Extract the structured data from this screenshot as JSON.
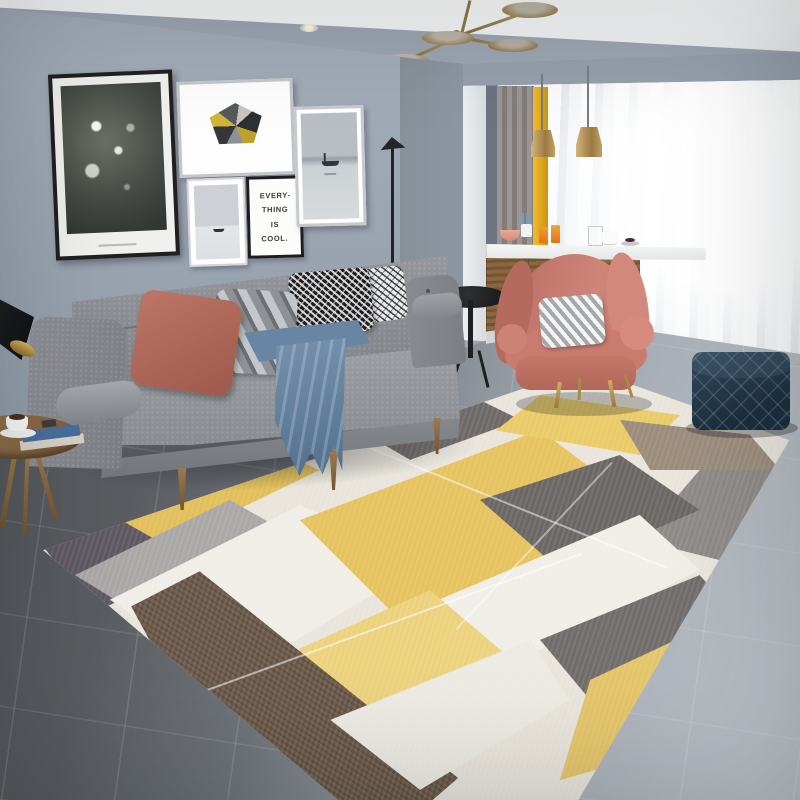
{
  "meta": {
    "title": "Scandinavian living room with yellow-gray geometric area rug",
    "image_type": "interior photograph, no UI text except framed quote art"
  },
  "wall_art": {
    "quote": {
      "lines": [
        "EVERY-",
        "THING",
        "IS",
        "COOL."
      ]
    },
    "frames": [
      "black-framed black & white botanical photo",
      "silver-framed geometric gem print (gold, black, marble triangles)",
      "small white-framed seascape with boat",
      "black-framed handwritten quote print",
      "silver-framed seascape with fisherman boat"
    ]
  },
  "palette": {
    "wall": "#9ca6b2",
    "wall_return": "#8d97a3",
    "ceiling": "#f6f7f8",
    "floor_dark": "#54575b",
    "floor_light": "#b9bec5",
    "sofa_gray": "#8d9094",
    "pillow_rose": "#b26a5c",
    "pillow_chevron_gray": "#8e9297",
    "blanket_blue": "#64819e",
    "armchair_pink": "#c87c70",
    "pouf_navy": "#22374a",
    "rug_yellow": "#e6c35f",
    "rug_pale_yellow": "#ecd27d",
    "rug_cream": "#f0eee7",
    "rug_gray": "#8d8a87",
    "rug_dark_gray": "#6b6765",
    "rug_plum_gray": "#5e5862",
    "rug_taupe": "#9b8c7c",
    "rug_brown": "#6f5c4d",
    "wood": "#8a6a4a",
    "brass": "#ab9060",
    "curtain_yellow": "#e8a820",
    "curtain_taupe": "#8f8a88",
    "curtain_sheer": "#f5f6f7"
  },
  "objects": [
    "brass sputnik chandelier",
    "recessed ceiling spotlight",
    "gallery wall of five frames",
    "black cone reading lamp",
    "gray three-seat fabric sofa",
    "rose pillow",
    "chevron pillow",
    "two houndstooth pillows",
    "blue throw blanket",
    "walnut tripod side table with coffee cup and books",
    "black slim floor lamp",
    "black round accent table",
    "bar counter with marble top and wood front",
    "orange juice glasses and mugs on counter",
    "two brass pendant lights",
    "sheer white curtains",
    "yellow and taupe curtain panels",
    "pink wingback armchair with chevron cushion and gold legs",
    "navy quilted cube pouf",
    "geometric patchwork area rug",
    "gray tile floor"
  ]
}
